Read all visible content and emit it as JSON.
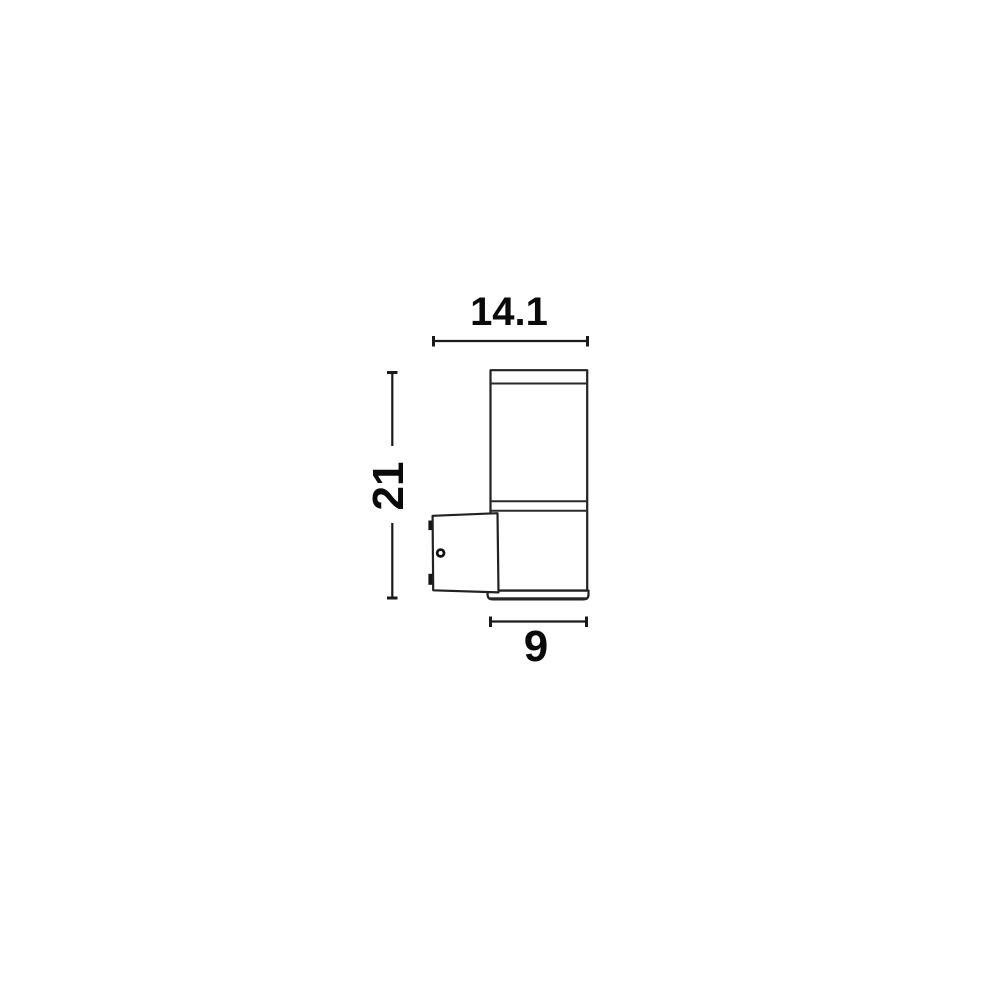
{
  "canvas": {
    "width": 1000,
    "height": 1000,
    "background": "#ffffff"
  },
  "colors": {
    "line": "#222222",
    "dimension_line": "#1a1a1a",
    "text": "#0a0a0a",
    "fill": "#ffffff",
    "clip_tab": "#151515"
  },
  "diagram": {
    "type": "technical-dimension-drawing",
    "labels": {
      "overall_depth": "14.1",
      "overall_height": "21",
      "body_diameter": "9"
    }
  }
}
